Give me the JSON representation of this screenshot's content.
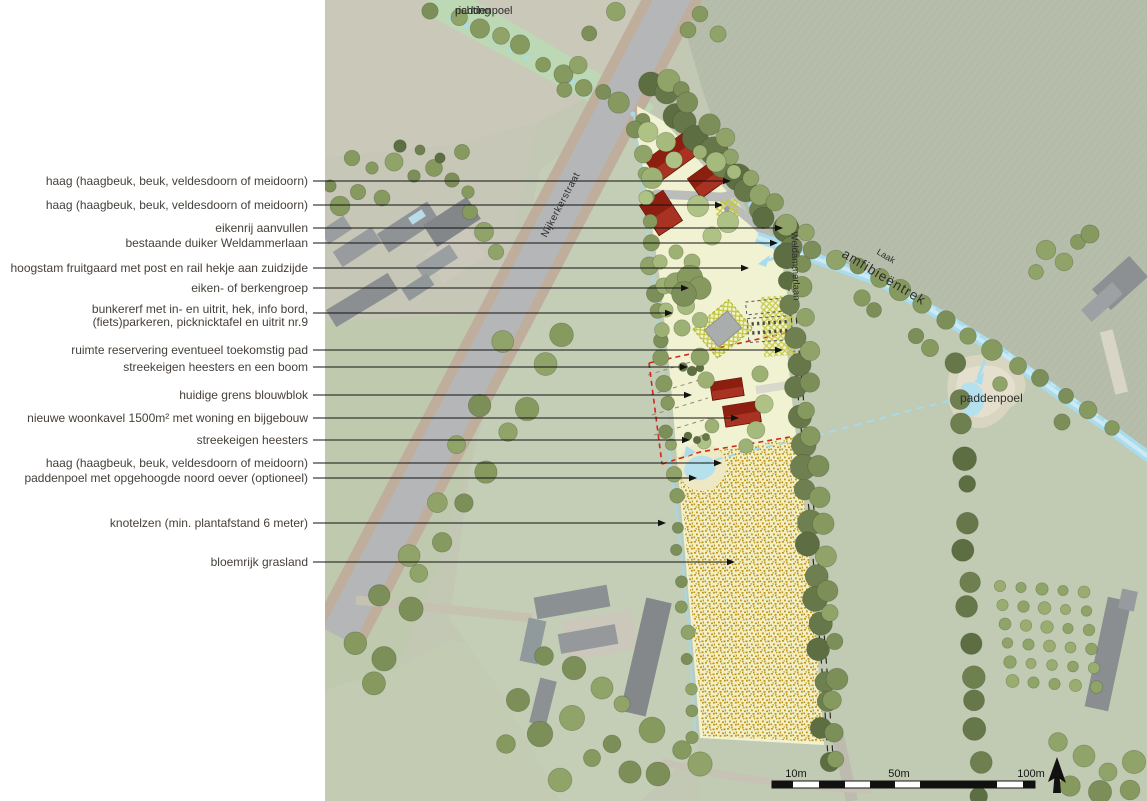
{
  "page": {
    "background": "#ffffff"
  },
  "colors": {
    "leader_line": "#121212",
    "plan_cream": "#f3f3d2",
    "grass_gold": "#c2951c",
    "water_blue": "#a9dcec",
    "building_red": "#a93322",
    "building_red_dark": "#8c1f10",
    "road_grey": "#b4b6b8",
    "bike_lane_tan": "#c0ae9c",
    "boundary_red_dash": "#cc2a1a",
    "scale_black": "#111111"
  },
  "annotations": [
    {
      "lines": [
        "haag (haagbeuk, beuk, veldesdoorn of meidoorn)"
      ],
      "y": 181,
      "tx": 731
    },
    {
      "lines": [
        "haag (haagbeuk, beuk, veldesdoorn of meidoorn)"
      ],
      "y": 205,
      "tx": 723
    },
    {
      "lines": [
        "eikenrij aanvullen"
      ],
      "y": 228,
      "tx": 783
    },
    {
      "lines": [
        "bestaande duiker Weldammerlaan"
      ],
      "y": 243,
      "tx": 778
    },
    {
      "lines": [
        "hoogstam fruitgaard met post en rail hekje aan zuidzijde"
      ],
      "y": 268,
      "tx": 749
    },
    {
      "lines": [
        "eiken- of berkengroep"
      ],
      "y": 288,
      "tx": 689
    },
    {
      "lines": [
        "bunkererf met in- en uitrit, hek, info bord,",
        "(fiets)parkeren, picknicktafel en uitrit nr.9"
      ],
      "y": 316,
      "ty": 313,
      "tx": 673
    },
    {
      "lines": [
        "ruimte reservering eventueel toekomstig pad"
      ],
      "y": 350,
      "tx": 783
    },
    {
      "lines": [
        "streekeigen heesters en een boom"
      ],
      "y": 367,
      "tx": 688
    },
    {
      "lines": [
        "huidige grens blouwblok"
      ],
      "y": 395,
      "tx": 692
    },
    {
      "lines": [
        "nieuwe woonkavel 1500m² met woning en bijgebouw"
      ],
      "y": 418,
      "tx": 739
    },
    {
      "lines": [
        "streekeigen heesters"
      ],
      "y": 440,
      "tx": 690
    },
    {
      "lines": [
        "haag (haagbeuk, beuk, veldesdoorn of meidoorn)"
      ],
      "y": 463,
      "tx": 722
    },
    {
      "lines": [
        "paddenpoel met opgehoogde noord oever (optioneel)"
      ],
      "y": 478,
      "tx": 697
    },
    {
      "lines": [
        "knotelzen (min. plantafstand 6 meter)"
      ],
      "y": 523,
      "tx": 666
    },
    {
      "lines": [
        "bloemrijk grasland"
      ],
      "y": 562,
      "tx": 735
    }
  ],
  "map_labels": {
    "richting_line1": "richting",
    "richting_line2": "paddenpoel",
    "nijkerkerstraat": "Nijkerkerstraat",
    "weldammerlaan": "Weldammerlaan",
    "laak": "Laak",
    "amfibieentrek": "amfibieëntrek",
    "paddenpoel": "paddenpoel"
  },
  "scalebar": {
    "l1": "10m",
    "l2": "50m",
    "l3": "100m"
  }
}
